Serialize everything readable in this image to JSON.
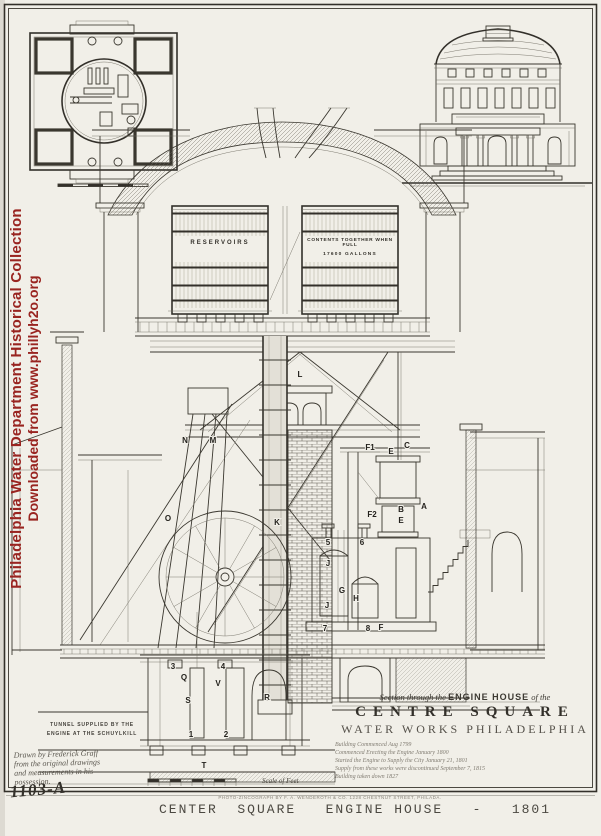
{
  "colors": {
    "paper": "#f1efe8",
    "ink": "#3a372f",
    "watermark_red": "#992420"
  },
  "watermark": {
    "line1": "Philadelphia Water Department Historical Collection",
    "line2": "Downloaded from www.phillyh2o.org"
  },
  "tanks": {
    "left_label": "RESERVOIRS",
    "right_label_line1": "CONTENTS TOGETHER WHEN FULL",
    "right_label_line2": "17600 GALLONS"
  },
  "tunnel_note": {
    "line1": "TUNNEL SUPPLIED BY THE",
    "line2": "ENGINE AT THE SCHUYLKILL"
  },
  "handwritten_note": {
    "line1": "Drawn by Frederick Graff",
    "line2": "from the original drawings",
    "line3": "and measurements in his",
    "line4": "possession."
  },
  "plate_number": "1103-A",
  "title_block": {
    "line1_prefix": "Section through the ",
    "line1_em": "ENGINE HOUSE",
    "line1_suffix": " of the",
    "line2": "CENTRE SQUARE",
    "line3": "WATER WORKS PHILADELPHIA",
    "notes": [
      "Building Commenced Aug 1799",
      "Commenced Erecting the Engine January 1800",
      "Started the Engine to Supply the City January 21, 1801",
      "Supply from these works were discontinued September 7, 1815",
      "Building taken down 1827"
    ]
  },
  "credit_line": "PHOTO-ZINCOGRAPH BY F. A. WENDEROTH & CO. 1228 CHESTNUT STREET, PHILADA.",
  "caption": "CENTER  SQUARE   ENGINE HOUSE   -   1801",
  "drawing_labels": [
    {
      "text": "L",
      "x": 300,
      "y": 377
    },
    {
      "text": "N",
      "x": 185,
      "y": 443
    },
    {
      "text": "M",
      "x": 213,
      "y": 443
    },
    {
      "text": "O",
      "x": 168,
      "y": 521
    },
    {
      "text": "K",
      "x": 277,
      "y": 525
    },
    {
      "text": "F1",
      "x": 370,
      "y": 450
    },
    {
      "text": "E",
      "x": 391,
      "y": 454
    },
    {
      "text": "C",
      "x": 407,
      "y": 448
    },
    {
      "text": "F2",
      "x": 372,
      "y": 517
    },
    {
      "text": "B",
      "x": 401,
      "y": 512
    },
    {
      "text": "E",
      "x": 401,
      "y": 523
    },
    {
      "text": "A",
      "x": 424,
      "y": 509
    },
    {
      "text": "J",
      "x": 328,
      "y": 566
    },
    {
      "text": "G",
      "x": 342,
      "y": 593
    },
    {
      "text": "H",
      "x": 356,
      "y": 601
    },
    {
      "text": "J",
      "x": 327,
      "y": 608
    },
    {
      "text": "5",
      "x": 328,
      "y": 545
    },
    {
      "text": "6",
      "x": 362,
      "y": 545
    },
    {
      "text": "7",
      "x": 325,
      "y": 631
    },
    {
      "text": "8",
      "x": 368,
      "y": 631
    },
    {
      "text": "F",
      "x": 381,
      "y": 630
    },
    {
      "text": "3",
      "x": 173,
      "y": 669
    },
    {
      "text": "4",
      "x": 223,
      "y": 669
    },
    {
      "text": "Q",
      "x": 184,
      "y": 680
    },
    {
      "text": "V",
      "x": 218,
      "y": 686
    },
    {
      "text": "S",
      "x": 188,
      "y": 703
    },
    {
      "text": "R",
      "x": 267,
      "y": 700
    },
    {
      "text": "1",
      "x": 191,
      "y": 737
    },
    {
      "text": "2",
      "x": 226,
      "y": 737
    },
    {
      "text": "T",
      "x": 204,
      "y": 768
    },
    {
      "text": "Scale of Feet",
      "x": 262,
      "y": 783,
      "cls": "script"
    }
  ]
}
